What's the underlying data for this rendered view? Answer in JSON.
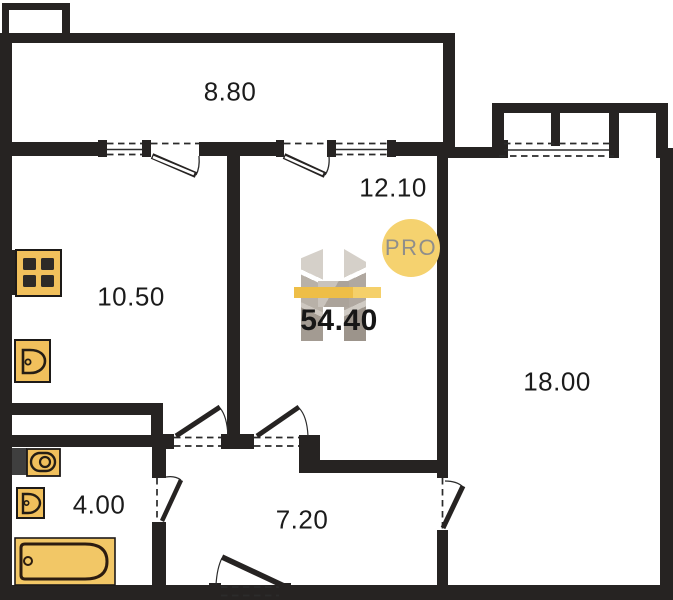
{
  "plan": {
    "total_area": "54.40",
    "logo": {
      "text": "PRO"
    },
    "rooms": [
      {
        "name": "balcony",
        "area": "8.80"
      },
      {
        "name": "room-12",
        "area": "12.10"
      },
      {
        "name": "kitchen",
        "area": "10.50"
      },
      {
        "name": "room-18",
        "area": "18.00"
      },
      {
        "name": "bathroom",
        "area": "4.00"
      },
      {
        "name": "hallway",
        "area": "7.20"
      }
    ],
    "fixtures": [
      {
        "icon": "stove-icon"
      },
      {
        "icon": "sink-icon"
      },
      {
        "icon": "washing-machine-icon"
      },
      {
        "icon": "toilet-icon"
      },
      {
        "icon": "bathtub-icon"
      }
    ],
    "colors": {
      "wall": "#262322",
      "fixture_fill": "#F1C05C",
      "bathtub_fill": "#F2C766",
      "washer_box": "#3F3F3F",
      "logo_circle": "#F5D26F",
      "logo_bar": "#F0C14B",
      "logo_gray": "#BCB5AD",
      "label_text": "#1B1B1B"
    }
  }
}
